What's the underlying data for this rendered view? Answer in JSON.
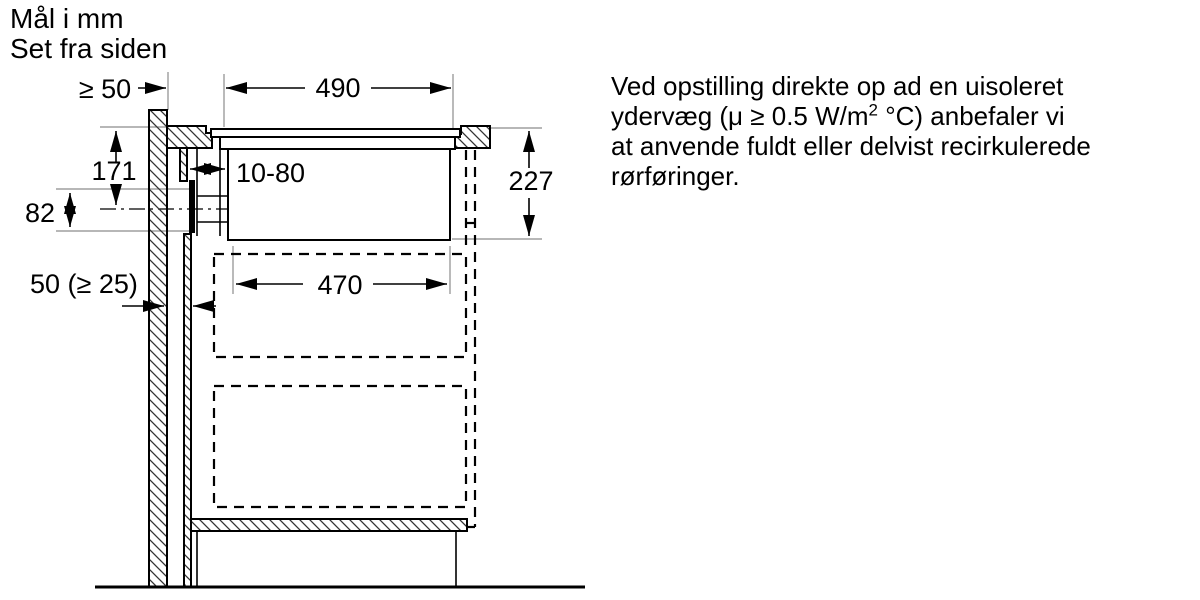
{
  "title": {
    "line1": "Mål i mm",
    "line2": "Set fra siden"
  },
  "dimensions": {
    "wall_clearance": "≥ 50",
    "cutout_width": "490",
    "top_to_outlet_axis": "171",
    "duct_adjust_range": "10-80",
    "outlet_height": "82",
    "unit_depth": "227",
    "rear_gap": "50 (≥ 25)",
    "inner_width": "470"
  },
  "note": {
    "line1": "Ved opstilling direkte op ad en uisoleret",
    "line2_pre": "ydervæg (μ ≥ 0.5 W/m",
    "line2_sup": "2",
    "line2_post": " °C) anbefaler vi",
    "line3": "at anvende fuldt eller delvist recirkulerede",
    "line4": "rørføringer."
  },
  "colors": {
    "ink": "#000000",
    "ext": "#8c8c8c",
    "bg": "#ffffff"
  }
}
